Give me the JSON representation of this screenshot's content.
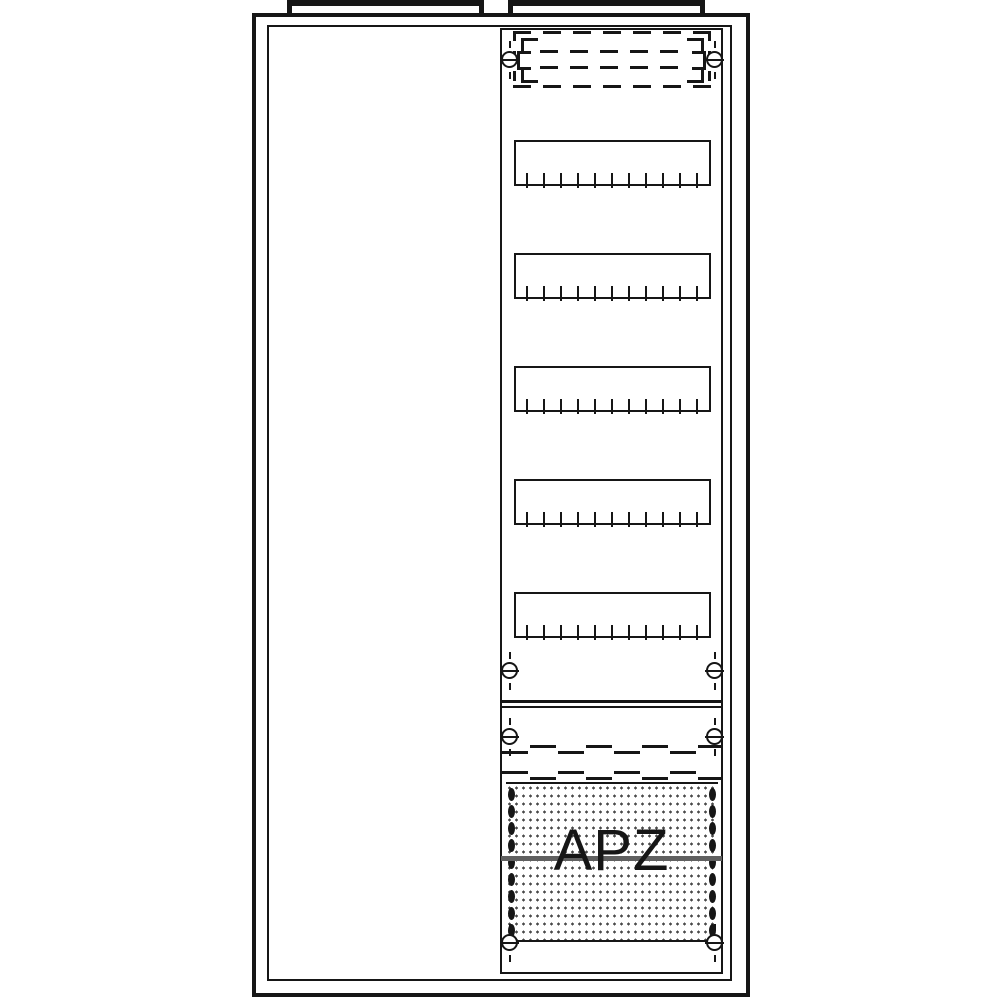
{
  "diagram": {
    "type": "electrical-distribution-board-front-view",
    "apz_label": "APZ",
    "colors": {
      "line": "#161616",
      "apz_divider": "#606060",
      "stipple": "#4a4a4a",
      "background": "#ffffff"
    },
    "structure": {
      "din_row_count": 5,
      "din_row_tops_px": [
        140,
        253,
        366,
        479,
        592
      ],
      "din_row_height_px": 46,
      "ticks_per_row": 11,
      "tick_spacing_px": 17,
      "screw_row_ys_px": [
        60,
        671,
        737,
        943
      ],
      "screw_column_xs_px": [
        510,
        715
      ],
      "dashed_joint_ys_px": [
        745,
        771
      ],
      "dashed_joint_dash_count": 8,
      "perforation_dots_per_side": 9
    }
  }
}
